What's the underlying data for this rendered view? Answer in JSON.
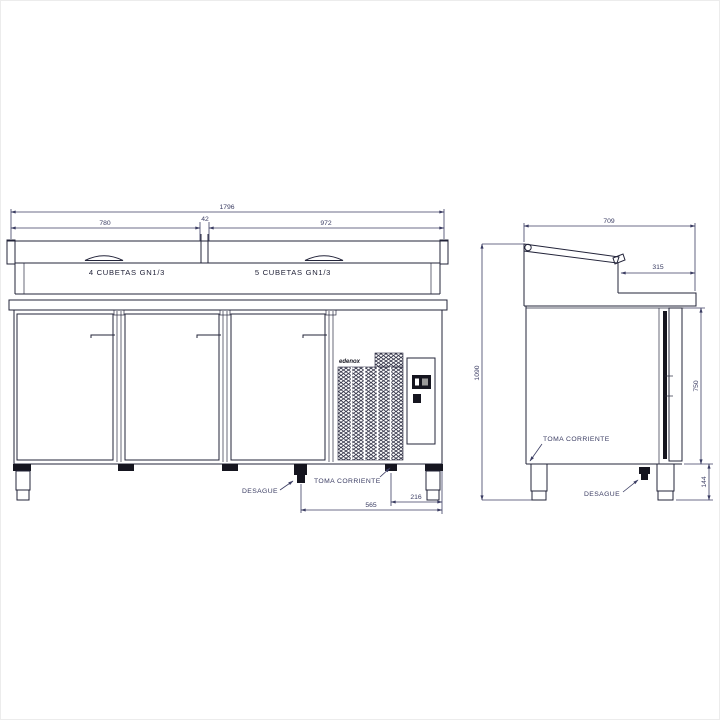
{
  "colors": {
    "line": "#23243a",
    "dim": "#3b3d63"
  },
  "front_view": {
    "dim_total_width": "1796",
    "dim_left_top": "780",
    "dim_center_gap": "42",
    "dim_right_top": "972",
    "label_left_wells": "4 CUBETAS GN1/3",
    "label_right_wells": "5 CUBETAS GN1/3",
    "label_drain": "DESAGUE",
    "label_power": "TOMA CORRIENTE",
    "dim_power_offset": "216",
    "dim_drain_offset": "565",
    "brand_logo": "edenox"
  },
  "side_view": {
    "dim_total_depth": "709",
    "dim_worktop_depth": "315",
    "dim_total_height": "1090",
    "dim_body_height": "750",
    "dim_leg_height": "144",
    "label_power": "TOMA CORRIENTE",
    "label_drain": "DESAGUE"
  }
}
